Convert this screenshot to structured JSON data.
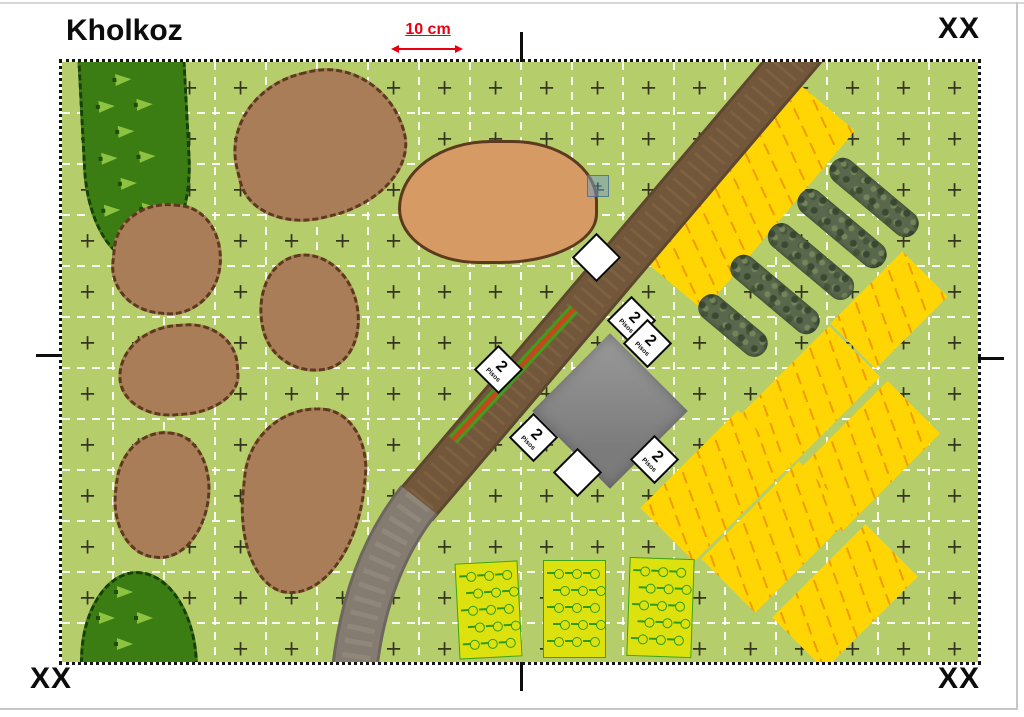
{
  "page": {
    "title": "Kholkoz",
    "scale_label": "10 cm",
    "corner_labels": {
      "top_right": "XX",
      "bottom_left": "XX",
      "bottom_right": "XX"
    }
  },
  "map": {
    "field_color": "#b6cd6c",
    "grid": {
      "cell": 51,
      "line_color": "rgba(255,255,255,0.9)",
      "cross_color": "#34341f",
      "cross_glyph": "+"
    },
    "road": {
      "dirt_path": "M 752,-26 L 353,444",
      "paved_path": "M 357,438 Q 300,510 291,624",
      "dirt_color": "#72573a",
      "paved_color": "#847c71"
    },
    "hedge": {
      "path": "M 512,247 L 391,378",
      "green": "#3f9e1b",
      "red": "#c04a1e"
    },
    "forests": [
      {
        "x": 20,
        "y": -30,
        "w": 102,
        "h": 225,
        "radius": "18% 22% 52% 48% / 10% 12% 45% 42%",
        "rot": -3
      },
      {
        "x": 18,
        "y": 509,
        "w": 112,
        "h": 118,
        "radius": "48% 52% 4% 4% / 72% 78% 0% 0%",
        "rot": 0
      }
    ],
    "rough_patches": [
      {
        "x": 170,
        "y": 8,
        "w": 168,
        "h": 142,
        "radius": "52% 48% 55% 45% / 55% 60% 45% 40%",
        "rot": -14
      },
      {
        "x": 50,
        "y": 141,
        "w": 104,
        "h": 106,
        "radius": "55% 45% 50% 50% / 48% 55% 52% 45%",
        "rot": 6
      },
      {
        "x": 197,
        "y": 191,
        "w": 94,
        "h": 114,
        "radius": "50% 50% 45% 55% / 55% 50% 50% 45%",
        "rot": -14
      },
      {
        "x": 56,
        "y": 262,
        "w": 115,
        "h": 86,
        "radius": "55% 45% 52% 48% / 60% 52% 44% 48%",
        "rot": -4
      },
      {
        "x": 52,
        "y": 369,
        "w": 90,
        "h": 122,
        "radius": "52% 48% 50% 50% / 46% 50% 54% 50%",
        "rot": 6
      },
      {
        "x": 179,
        "y": 344,
        "w": 117,
        "h": 183,
        "radius": "60% 40% 55% 45% / 40% 34% 60% 52%",
        "rot": 6
      }
    ],
    "clearing": {
      "x": 336,
      "y": 78,
      "w": 194,
      "h": 118,
      "radius": "52% 48% 55% 45% / 62% 55% 45% 50%"
    },
    "yellow_fields": [
      {
        "cx": 688,
        "cy": 134,
        "w": 235,
        "h": 75,
        "rot": -50
      },
      {
        "cx": 827,
        "cy": 248,
        "w": 102,
        "h": 64,
        "rot": -45
      },
      {
        "cx": 746,
        "cy": 336,
        "w": 132,
        "h": 72,
        "rot": -45
      },
      {
        "cx": 803,
        "cy": 394,
        "w": 138,
        "h": 74,
        "rot": -45
      },
      {
        "cx": 654,
        "cy": 424,
        "w": 138,
        "h": 76,
        "rot": -45
      },
      {
        "cx": 715,
        "cy": 475,
        "w": 138,
        "h": 76,
        "rot": -45
      },
      {
        "cx": 783,
        "cy": 535,
        "w": 132,
        "h": 74,
        "rot": -45
      }
    ],
    "bushes": [
      {
        "cx": 812,
        "cy": 135,
        "len": 108,
        "rot": 40
      },
      {
        "cx": 780,
        "cy": 166,
        "len": 108,
        "rot": 40
      },
      {
        "cx": 749,
        "cy": 199,
        "len": 104,
        "rot": 40
      },
      {
        "cx": 713,
        "cy": 232,
        "len": 108,
        "rot": 40
      },
      {
        "cx": 671,
        "cy": 263,
        "len": 82,
        "rot": 40
      }
    ],
    "crop_fields": [
      {
        "x": 395,
        "y": 500,
        "w": 61,
        "h": 94,
        "rot": -3
      },
      {
        "x": 481,
        "y": 498,
        "w": 61,
        "h": 96,
        "rot": 0
      },
      {
        "x": 566,
        "y": 496,
        "w": 63,
        "h": 97,
        "rot": 2
      }
    ],
    "building": {
      "cx": 548,
      "cy": 349,
      "size": 110,
      "color": "#8f8f8f"
    },
    "markers": [
      {
        "cx": 535,
        "cy": 196,
        "label_value": "",
        "label_caption": ""
      },
      {
        "cx": 570,
        "cy": 259,
        "label_value": "2",
        "label_caption": "Pisos"
      },
      {
        "cx": 586,
        "cy": 282,
        "label_value": "2",
        "label_caption": "Pisos"
      },
      {
        "cx": 437,
        "cy": 308,
        "label_value": "2",
        "label_caption": "Pisos"
      },
      {
        "cx": 472,
        "cy": 376,
        "label_value": "2",
        "label_caption": "Pisos"
      },
      {
        "cx": 516,
        "cy": 411,
        "label_value": "",
        "label_caption": ""
      },
      {
        "cx": 593,
        "cy": 398,
        "label_value": "2",
        "label_caption": "Pisos"
      }
    ],
    "selection": {
      "cx": 536,
      "cy": 124,
      "size": 22
    }
  }
}
